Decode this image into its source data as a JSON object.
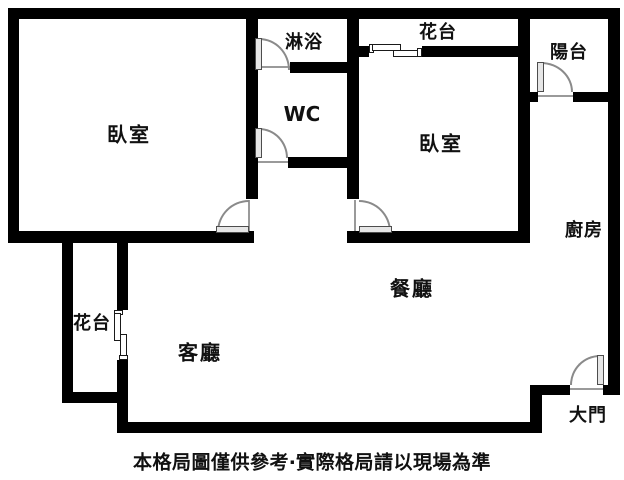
{
  "plan": {
    "type": "apartment-floor-plan",
    "labels": {
      "bedroom_left": "臥室",
      "shower": "淋浴",
      "wc": "WC",
      "flower_top": "花台",
      "balcony": "陽台",
      "bedroom_right": "臥室",
      "kitchen": "廚房",
      "dining": "餐廳",
      "flower_left": "花台",
      "living": "客廳",
      "main_door": "大門",
      "caption": "本格局圖僅供參考‧實際格局請以現場為準"
    },
    "colors": {
      "background": "#ffffff",
      "wall": "#000000",
      "door_panel": "#e6e6e6",
      "door_arc": "#8a8a8a",
      "text": "#111111"
    },
    "symbols": {
      "doors": [
        "bedroom-left-door",
        "bedroom-right-door",
        "shower-door",
        "wc-door",
        "balcony-door",
        "main-entry-door"
      ],
      "windows": [
        "bedroom-right-top-window",
        "flower-left-window"
      ]
    }
  }
}
